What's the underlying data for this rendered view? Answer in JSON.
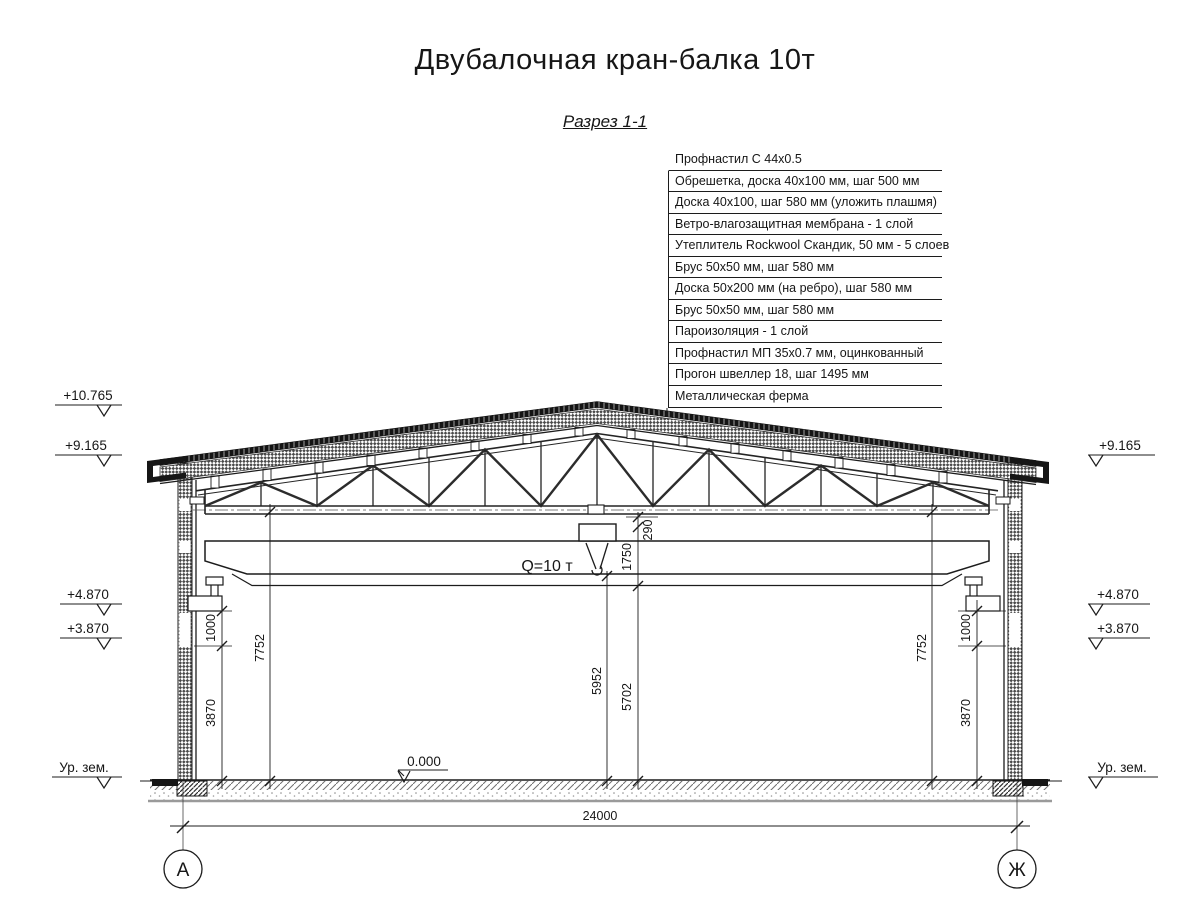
{
  "title": "Двубалочная кран-балка 10т",
  "section_label": "Разрез 1-1",
  "roof_callout": {
    "items": [
      "Профнастил С 44х0.5",
      "Обрешетка, доска 40х100 мм, шаг 500 мм",
      "Доска 40х100, шаг 580 мм (уложить плашмя)",
      "Ветро-влагозащитная мембрана - 1 слой",
      "Утеплитель Rockwool Скандик, 50 мм - 5 слоев",
      "Брус 50х50 мм, шаг 580 мм",
      "Доска 50х200 мм (на ребро), шаг 580 мм",
      "Брус 50х50 мм, шаг 580 мм",
      "Пароизоляция - 1 слой",
      "Профнастил МП 35х0.7 мм, оцинкованный",
      "Прогон швеллер 18, шаг 1495 мм",
      "Металлическая ферма"
    ]
  },
  "crane": {
    "capacity": "Q=10 т"
  },
  "elevations": {
    "ridge": "+10.765",
    "eaves": "+9.165",
    "crane_rail": "+4.870",
    "corbel": "+3.870",
    "zero": "0.000",
    "ground": "Ур. зем."
  },
  "dims": {
    "gap_290": "290",
    "crane_1750": "1750",
    "hook_5952": "5952",
    "clear_5702": "5702",
    "truss_7752": "7752",
    "corbel_1000": "1000",
    "col_3870": "3870",
    "span": "24000"
  },
  "axes": {
    "left": "А",
    "right": "Ж"
  },
  "colors": {
    "line": "#1c1c1c",
    "grey_line": "#9a9a9a",
    "dark_fill": "#151515"
  }
}
